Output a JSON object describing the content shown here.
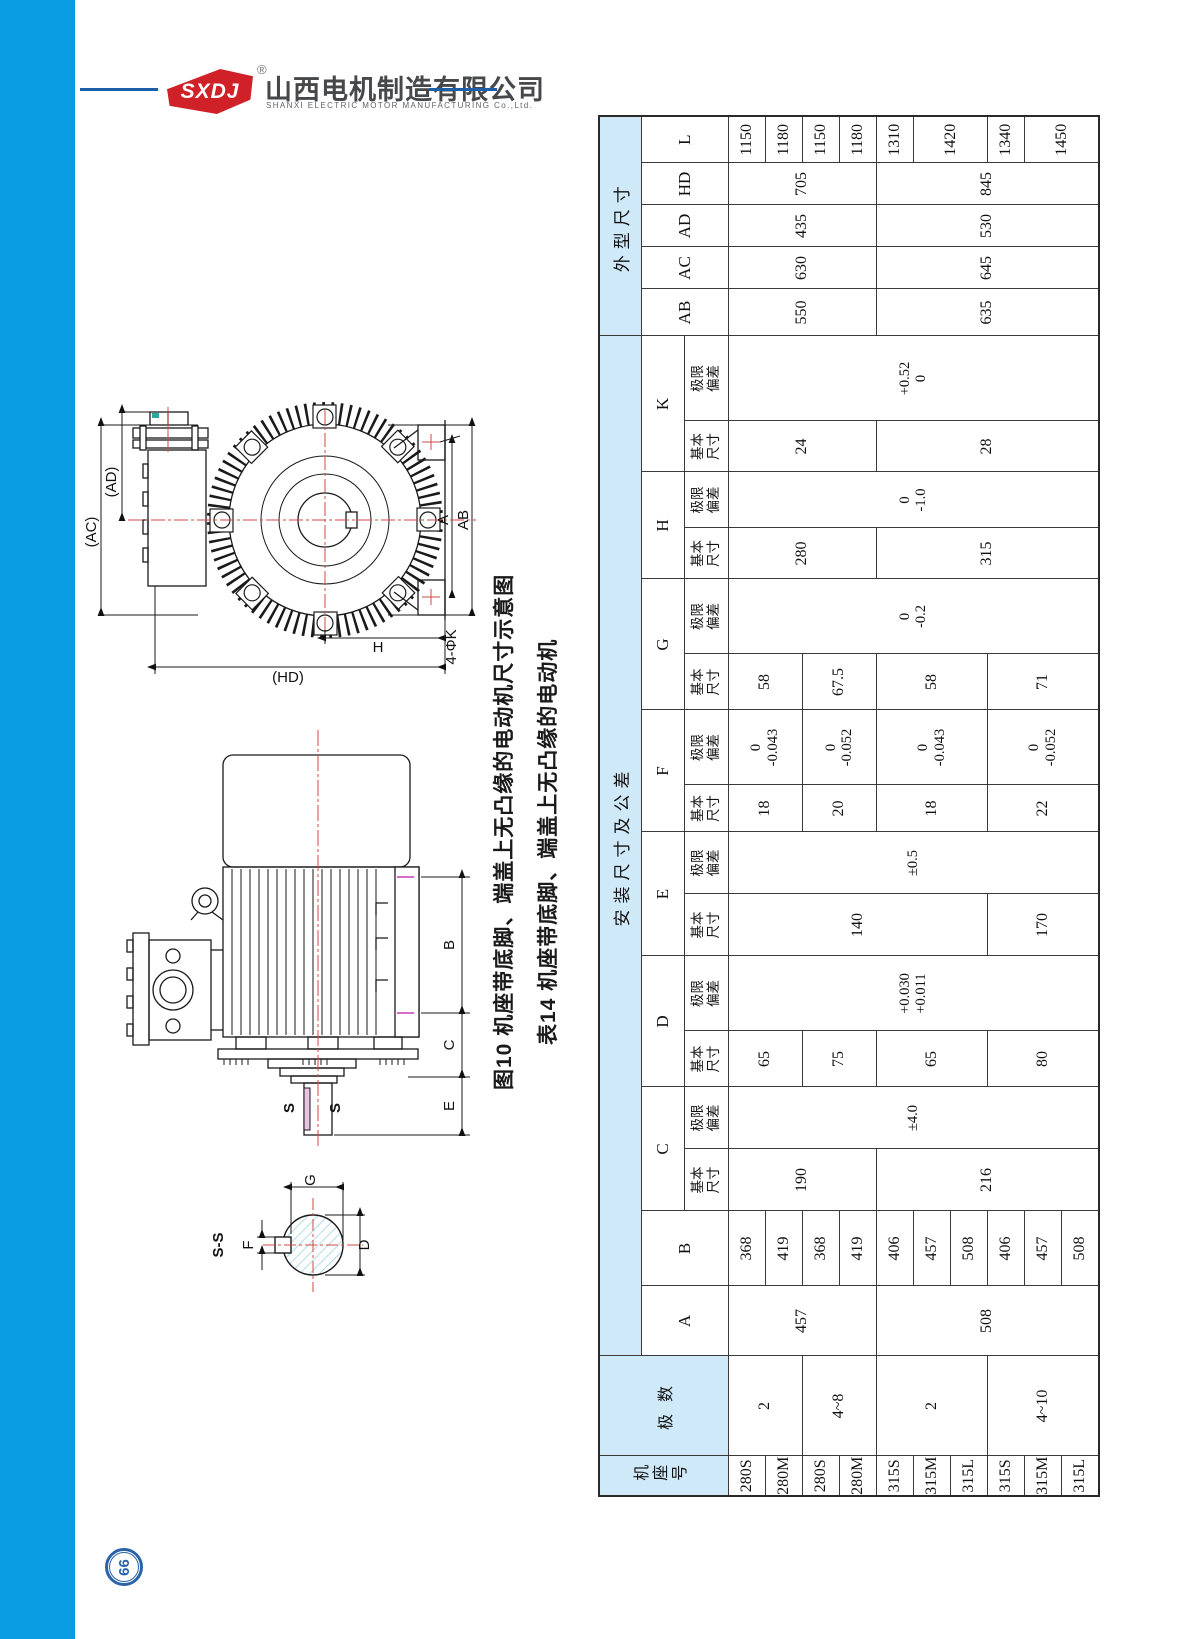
{
  "logo": {
    "abbr": "SXDJ",
    "reg": "®",
    "cn": "山西电机制造有限公司",
    "en": "SHANXI ELECTRIC MOTOR MANUFACTURING Co.,Ltd."
  },
  "captions": {
    "figure": "图10 机座带底脚、端盖上无凸缘的电动机尺寸示意图",
    "table": "表14 机座带底脚、端盖上无凸缘的电动机"
  },
  "page": {
    "number": "66"
  },
  "colors": {
    "accent_bar": "#0a9ce2",
    "header_blue": "#cfe9f8",
    "logo_red": "#cf2127",
    "rule_blue": "#1b5fa8",
    "badge_blue": "#2a63a8",
    "centerline_red": "#d24a42",
    "hatch_blue": "#9fd4e8"
  },
  "dw": {
    "AD": "(AD)",
    "AC": "(AC)",
    "A": "A",
    "AB": "AB",
    "H": "H",
    "HD": "(HD)",
    "K4": "4-ΦK",
    "B": "B",
    "C": "C",
    "E": "E",
    "S1": "S",
    "S2": "S",
    "SS": "S-S",
    "G": "G",
    "D": "D",
    "F": "F"
  },
  "t": {
    "frame_hdr": "机座号",
    "poles_hdr": "极 数",
    "install": "安装尺寸及公差",
    "outline": "外型尺寸",
    "basic": "基本\n尺寸",
    "dev": "极限\n偏差",
    "lA": "A",
    "lB": "B",
    "lC": "C",
    "lD": "D",
    "lE": "E",
    "lF": "F",
    "lG": "G",
    "lH": "H",
    "lK": "K",
    "lAB": "AB",
    "lAC": "AC",
    "lAD": "AD",
    "lHD": "HD",
    "lL": "L",
    "frames": [
      "280S",
      "280M",
      "280S",
      "280M",
      "315S",
      "315M",
      "315L",
      "315S",
      "315M",
      "315L"
    ],
    "poles": [
      "2",
      "4~8",
      "2",
      "4~10"
    ],
    "A": [
      "457",
      "508"
    ],
    "B": [
      "368",
      "419",
      "368",
      "419",
      "406",
      "457",
      "508",
      "406",
      "457",
      "508"
    ],
    "C": [
      "190",
      "216"
    ],
    "C_dev": "±4.0",
    "D": [
      "65",
      "75",
      "65",
      "80"
    ],
    "D_dev": "+0.030\n+0.011",
    "E": [
      "140",
      "170"
    ],
    "E_dev": "±0.5",
    "F": [
      "18",
      "20",
      "18",
      "22"
    ],
    "F_dev": [
      "0\n-0.043",
      "0\n-0.052",
      "0\n-0.043",
      "0\n-0.052"
    ],
    "G": [
      "58",
      "67.5",
      "58",
      "71"
    ],
    "G_dev": "0\n-0.2",
    "H": [
      "280",
      "315"
    ],
    "H_dev": "0\n-1.0",
    "K": [
      "24",
      "28"
    ],
    "K_dev": "+0.52\n0",
    "AB": [
      "550",
      "635"
    ],
    "AC": [
      "630",
      "645"
    ],
    "AD": [
      "435",
      "530"
    ],
    "HD": [
      "705",
      "845"
    ],
    "L": [
      "1150",
      "1180",
      "1150",
      "1180",
      "1310",
      "1420",
      "1340",
      "1450"
    ]
  }
}
